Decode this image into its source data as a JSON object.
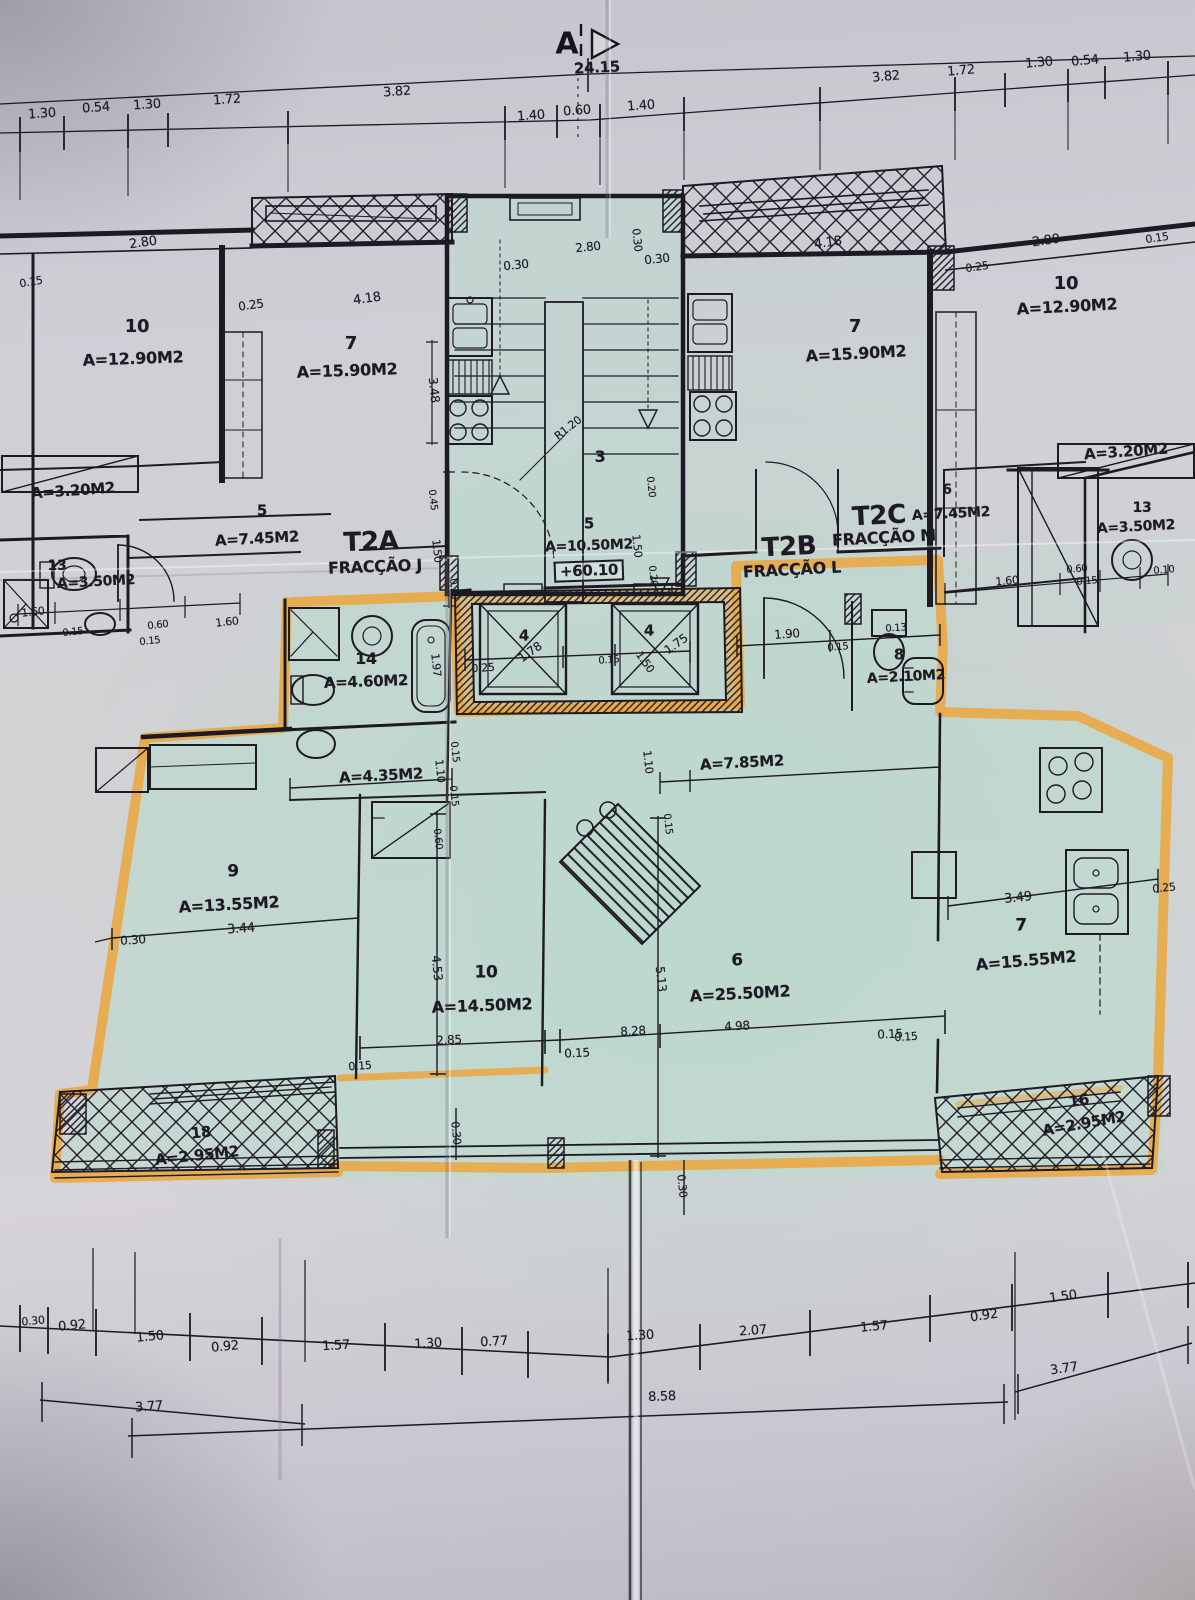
{
  "marker": {
    "letter": "A"
  },
  "colors": {
    "paper": "#cdc9d1",
    "blueprint_tint": "#bfdcd1",
    "ink": "#1b1822",
    "highlighter_orange": "#efa233"
  },
  "fractions": [
    {
      "code": "T2A",
      "name": "FRACÇÃO J"
    },
    {
      "code": "T2B",
      "name": "FRACÇÃO L"
    },
    {
      "code": "T2C",
      "name": "FRACÇÃO M"
    }
  ],
  "level_mark": "+60.10",
  "overall_width_dim": "24.15",
  "labels": [
    {
      "t": "24.15",
      "x": 597,
      "y": 68,
      "r": -3,
      "s": 15,
      "w": 1,
      "n": "overall-dim"
    },
    {
      "t": "1.30",
      "x": 42,
      "y": 114,
      "r": -4,
      "s": 13
    },
    {
      "t": "0.54",
      "x": 96,
      "y": 108,
      "r": -4,
      "s": 13
    },
    {
      "t": "1.30",
      "x": 147,
      "y": 105,
      "r": -4,
      "s": 13
    },
    {
      "t": "1.72",
      "x": 227,
      "y": 100,
      "r": -4,
      "s": 13
    },
    {
      "t": "3.82",
      "x": 397,
      "y": 92,
      "r": -4,
      "s": 13
    },
    {
      "t": "1.40",
      "x": 531,
      "y": 116,
      "r": -4,
      "s": 13
    },
    {
      "t": "0.60",
      "x": 577,
      "y": 111,
      "r": -4,
      "s": 13
    },
    {
      "t": "1.40",
      "x": 641,
      "y": 106,
      "r": -4,
      "s": 13
    },
    {
      "t": "3.82",
      "x": 886,
      "y": 77,
      "r": -5,
      "s": 13
    },
    {
      "t": "1.72",
      "x": 961,
      "y": 71,
      "r": -5,
      "s": 13
    },
    {
      "t": "1.30",
      "x": 1039,
      "y": 63,
      "r": -5,
      "s": 13
    },
    {
      "t": "0.54",
      "x": 1085,
      "y": 61,
      "r": -5,
      "s": 13
    },
    {
      "t": "1.30",
      "x": 1137,
      "y": 57,
      "r": -5,
      "s": 13
    },
    {
      "t": "0.15",
      "x": 31,
      "y": 282,
      "r": -10,
      "s": 11
    },
    {
      "t": "2.80",
      "x": 143,
      "y": 243,
      "r": -8,
      "s": 13
    },
    {
      "t": "10",
      "x": 137,
      "y": 327,
      "r": 0,
      "s": 18,
      "w": 1,
      "n": "room-number"
    },
    {
      "t": "A=12.90M2",
      "x": 133,
      "y": 359,
      "r": -2,
      "s": 16,
      "w": 1,
      "n": "room-area"
    },
    {
      "t": "0.25",
      "x": 251,
      "y": 305,
      "r": -8,
      "s": 12
    },
    {
      "t": "4.18",
      "x": 367,
      "y": 299,
      "r": -8,
      "s": 13
    },
    {
      "t": "7",
      "x": 351,
      "y": 344,
      "r": 0,
      "s": 18,
      "w": 1,
      "n": "room-number"
    },
    {
      "t": "A=15.90M2",
      "x": 347,
      "y": 371,
      "r": -2,
      "s": 16,
      "w": 1,
      "n": "room-area"
    },
    {
      "t": "3.48",
      "x": 434,
      "y": 390,
      "r": 84,
      "s": 12
    },
    {
      "t": "A=3.20M2",
      "x": 73,
      "y": 491,
      "r": -4,
      "s": 15,
      "w": 1,
      "n": "room-area"
    },
    {
      "t": "5",
      "x": 262,
      "y": 511,
      "r": 0,
      "s": 15,
      "w": 1,
      "n": "room-number"
    },
    {
      "t": "A=7.45M2",
      "x": 257,
      "y": 539,
      "r": -3,
      "s": 15,
      "w": 1,
      "n": "room-area"
    },
    {
      "t": "13",
      "x": 57,
      "y": 566,
      "r": 0,
      "s": 14,
      "w": 1,
      "n": "room-number"
    },
    {
      "t": "A=3.50M2",
      "x": 96,
      "y": 582,
      "r": -3,
      "s": 14,
      "w": 1,
      "n": "room-area"
    },
    {
      "t": "1.60",
      "x": 33,
      "y": 612,
      "r": -6,
      "s": 11
    },
    {
      "t": "0.15",
      "x": 73,
      "y": 633,
      "r": -6,
      "s": 10
    },
    {
      "t": "0.60",
      "x": 158,
      "y": 626,
      "r": -6,
      "s": 10
    },
    {
      "t": "0.15",
      "x": 150,
      "y": 642,
      "r": -6,
      "s": 10
    },
    {
      "t": "1.60",
      "x": 227,
      "y": 622,
      "r": -6,
      "s": 11
    },
    {
      "t": "0.30",
      "x": 516,
      "y": 265,
      "r": -6,
      "s": 12
    },
    {
      "t": "2.80",
      "x": 588,
      "y": 247,
      "r": -6,
      "s": 12
    },
    {
      "t": "0.30",
      "x": 637,
      "y": 240,
      "r": 84,
      "s": 11
    },
    {
      "t": "0.30",
      "x": 657,
      "y": 259,
      "r": -6,
      "s": 12
    },
    {
      "t": "R1.20",
      "x": 568,
      "y": 428,
      "r": -38,
      "s": 11
    },
    {
      "t": "3",
      "x": 600,
      "y": 457,
      "r": 0,
      "s": 16,
      "w": 1,
      "n": "room-number"
    },
    {
      "t": "0.20",
      "x": 650,
      "y": 487,
      "r": 84,
      "s": 10
    },
    {
      "t": "0.45",
      "x": 432,
      "y": 500,
      "r": 84,
      "s": 10
    },
    {
      "t": "1.50",
      "x": 437,
      "y": 551,
      "r": 84,
      "s": 11
    },
    {
      "t": "0.30",
      "x": 453,
      "y": 589,
      "r": 84,
      "s": 10
    },
    {
      "t": "1.50",
      "x": 637,
      "y": 546,
      "r": 84,
      "s": 11
    },
    {
      "t": "0.20",
      "x": 652,
      "y": 576,
      "r": 84,
      "s": 10
    },
    {
      "t": "4.18",
      "x": 828,
      "y": 243,
      "r": -8,
      "s": 13
    },
    {
      "t": "0.25",
      "x": 977,
      "y": 267,
      "r": -8,
      "s": 11
    },
    {
      "t": "2.80",
      "x": 1046,
      "y": 241,
      "r": -8,
      "s": 13
    },
    {
      "t": "0.15",
      "x": 1157,
      "y": 238,
      "r": -8,
      "s": 11
    },
    {
      "t": "10",
      "x": 1066,
      "y": 284,
      "r": 0,
      "s": 18,
      "w": 1,
      "n": "room-number"
    },
    {
      "t": "A=12.90M2",
      "x": 1067,
      "y": 307,
      "r": -3,
      "s": 16,
      "w": 1,
      "n": "room-area"
    },
    {
      "t": "7",
      "x": 855,
      "y": 327,
      "r": 0,
      "s": 18,
      "w": 1,
      "n": "room-number"
    },
    {
      "t": "A=15.90M2",
      "x": 856,
      "y": 354,
      "r": -3,
      "s": 16,
      "w": 1,
      "n": "room-area"
    },
    {
      "t": "A=3.20M2",
      "x": 1126,
      "y": 452,
      "r": -4,
      "s": 15,
      "w": 1,
      "n": "room-area"
    },
    {
      "t": "6",
      "x": 947,
      "y": 490,
      "r": 0,
      "s": 14,
      "w": 1,
      "n": "room-number"
    },
    {
      "t": "A=7.45M2",
      "x": 951,
      "y": 514,
      "r": -3,
      "s": 14,
      "w": 1,
      "n": "room-area"
    },
    {
      "t": "T2C",
      "x": 879,
      "y": 516,
      "r": -3,
      "s": 26,
      "w": 1,
      "n": "fraction-t2c-code"
    },
    {
      "t": "FRACÇÃO M",
      "x": 884,
      "y": 538,
      "r": -3,
      "s": 16,
      "w": 1,
      "n": "fraction-t2c-name"
    },
    {
      "t": "T2B",
      "x": 789,
      "y": 547,
      "r": -3,
      "s": 26,
      "w": 1,
      "n": "fraction-t2b-code"
    },
    {
      "t": "FRACÇÃO L",
      "x": 792,
      "y": 570,
      "r": -3,
      "s": 16,
      "w": 1,
      "n": "fraction-t2b-name"
    },
    {
      "t": "13",
      "x": 1142,
      "y": 508,
      "r": 0,
      "s": 14,
      "w": 1,
      "n": "room-number"
    },
    {
      "t": "A=3.50M2",
      "x": 1136,
      "y": 527,
      "r": -3,
      "s": 14,
      "w": 1,
      "n": "room-area"
    },
    {
      "t": "1.60",
      "x": 1007,
      "y": 581,
      "r": -5,
      "s": 11
    },
    {
      "t": "0.60",
      "x": 1077,
      "y": 570,
      "r": -5,
      "s": 10
    },
    {
      "t": "0.15",
      "x": 1087,
      "y": 582,
      "r": -5,
      "s": 10
    },
    {
      "t": "0.10",
      "x": 1164,
      "y": 571,
      "r": -5,
      "s": 10
    },
    {
      "t": "T2A",
      "x": 371,
      "y": 542,
      "r": -2,
      "s": 26,
      "w": 1,
      "n": "fraction-t2a-code"
    },
    {
      "t": "FRACÇÃO J",
      "x": 375,
      "y": 567,
      "r": -2,
      "s": 16,
      "w": 1,
      "n": "fraction-t2a-name"
    },
    {
      "t": "5",
      "x": 589,
      "y": 524,
      "r": 0,
      "s": 15,
      "w": 1,
      "n": "room-number"
    },
    {
      "t": "A=10.50M2",
      "x": 589,
      "y": 546,
      "r": -2,
      "s": 14,
      "w": 1,
      "n": "room-area"
    },
    {
      "t": "+60.10",
      "x": 589,
      "y": 571,
      "r": -2,
      "s": 15,
      "w": 1,
      "b": 1,
      "n": "level-mark"
    },
    {
      "t": "14",
      "x": 366,
      "y": 659,
      "r": 0,
      "s": 16,
      "w": 1,
      "n": "room-number"
    },
    {
      "t": "A=4.60M2",
      "x": 366,
      "y": 682,
      "r": -2,
      "s": 15,
      "w": 1,
      "n": "room-area"
    },
    {
      "t": "1.97",
      "x": 436,
      "y": 665,
      "r": 84,
      "s": 11
    },
    {
      "t": "0.25",
      "x": 483,
      "y": 668,
      "r": -4,
      "s": 11
    },
    {
      "t": "4",
      "x": 524,
      "y": 636,
      "r": 0,
      "s": 15,
      "w": 1,
      "n": "room-number"
    },
    {
      "t": "1.78",
      "x": 530,
      "y": 652,
      "r": -35,
      "s": 12
    },
    {
      "t": "0.15",
      "x": 609,
      "y": 661,
      "r": -4,
      "s": 10
    },
    {
      "t": "1.50",
      "x": 645,
      "y": 662,
      "r": 55,
      "s": 11
    },
    {
      "t": "4",
      "x": 649,
      "y": 631,
      "r": 0,
      "s": 15,
      "w": 1,
      "n": "room-number"
    },
    {
      "t": "1.75",
      "x": 676,
      "y": 644,
      "r": -35,
      "s": 12
    },
    {
      "t": "1.90",
      "x": 787,
      "y": 634,
      "r": -4,
      "s": 12
    },
    {
      "t": "0.15",
      "x": 838,
      "y": 648,
      "r": -4,
      "s": 10
    },
    {
      "t": "0.13",
      "x": 896,
      "y": 629,
      "r": -4,
      "s": 10
    },
    {
      "t": "8",
      "x": 899,
      "y": 655,
      "r": 0,
      "s": 15,
      "w": 1,
      "n": "room-number"
    },
    {
      "t": "A=2.10M2",
      "x": 906,
      "y": 677,
      "r": -3,
      "s": 14,
      "w": 1,
      "n": "room-area"
    },
    {
      "t": "A=4.35M2",
      "x": 381,
      "y": 776,
      "r": -3,
      "s": 15,
      "w": 1,
      "n": "room-area"
    },
    {
      "t": "1.10",
      "x": 440,
      "y": 771,
      "r": 84,
      "s": 11
    },
    {
      "t": "0.15",
      "x": 454,
      "y": 752,
      "r": 84,
      "s": 10
    },
    {
      "t": "0.15",
      "x": 453,
      "y": 796,
      "r": 84,
      "s": 10
    },
    {
      "t": "0.60",
      "x": 437,
      "y": 839,
      "r": 84,
      "s": 10
    },
    {
      "t": "1.10",
      "x": 648,
      "y": 762,
      "r": 84,
      "s": 11
    },
    {
      "t": "0.15",
      "x": 667,
      "y": 824,
      "r": 84,
      "s": 10
    },
    {
      "t": "A=7.85M2",
      "x": 742,
      "y": 763,
      "r": -3,
      "s": 15,
      "w": 1,
      "n": "room-area"
    },
    {
      "t": "9",
      "x": 233,
      "y": 872,
      "r": 0,
      "s": 17,
      "w": 1,
      "n": "room-number"
    },
    {
      "t": "A=13.55M2",
      "x": 229,
      "y": 905,
      "r": -3,
      "s": 16,
      "w": 1,
      "n": "room-area"
    },
    {
      "t": "3.44",
      "x": 241,
      "y": 929,
      "r": -4,
      "s": 13
    },
    {
      "t": "0.30",
      "x": 133,
      "y": 940,
      "r": -4,
      "s": 12
    },
    {
      "t": "4.53",
      "x": 437,
      "y": 968,
      "r": 84,
      "s": 12
    },
    {
      "t": "10",
      "x": 486,
      "y": 973,
      "r": 0,
      "s": 17,
      "w": 1,
      "n": "room-number"
    },
    {
      "t": "A=14.50M2",
      "x": 482,
      "y": 1006,
      "r": -2,
      "s": 16,
      "w": 1,
      "n": "room-area"
    },
    {
      "t": "2.85",
      "x": 449,
      "y": 1040,
      "r": -3,
      "s": 12
    },
    {
      "t": "0.15",
      "x": 577,
      "y": 1053,
      "r": -3,
      "s": 12
    },
    {
      "t": "5.13",
      "x": 661,
      "y": 979,
      "r": 84,
      "s": 12
    },
    {
      "t": "8.28",
      "x": 633,
      "y": 1031,
      "r": -3,
      "s": 12
    },
    {
      "t": "6",
      "x": 737,
      "y": 961,
      "r": 0,
      "s": 17,
      "w": 1,
      "n": "room-number"
    },
    {
      "t": "A=25.50M2",
      "x": 740,
      "y": 994,
      "r": -3,
      "s": 16,
      "w": 1,
      "n": "room-area"
    },
    {
      "t": "4.98",
      "x": 737,
      "y": 1026,
      "r": -3,
      "s": 12
    },
    {
      "t": "0.15",
      "x": 890,
      "y": 1034,
      "r": -3,
      "s": 12
    },
    {
      "t": "3.49",
      "x": 1018,
      "y": 898,
      "r": -6,
      "s": 13
    },
    {
      "t": "7",
      "x": 1021,
      "y": 926,
      "r": 0,
      "s": 17,
      "w": 1,
      "n": "room-number"
    },
    {
      "t": "A=15.55M2",
      "x": 1026,
      "y": 961,
      "r": -5,
      "s": 16,
      "w": 1,
      "n": "room-area"
    },
    {
      "t": "0.25",
      "x": 1164,
      "y": 888,
      "r": -6,
      "s": 11
    },
    {
      "t": "0.15",
      "x": 906,
      "y": 1037,
      "r": -4,
      "s": 11
    },
    {
      "t": "0.15",
      "x": 360,
      "y": 1066,
      "r": -4,
      "s": 11
    },
    {
      "t": "18",
      "x": 201,
      "y": 1133,
      "r": -6,
      "s": 15,
      "w": 1,
      "n": "room-number"
    },
    {
      "t": "A=2.95M2",
      "x": 197,
      "y": 1156,
      "r": -6,
      "s": 15,
      "w": 1,
      "n": "room-area"
    },
    {
      "t": "0.30",
      "x": 456,
      "y": 1133,
      "r": 84,
      "s": 11
    },
    {
      "t": "0.30",
      "x": 682,
      "y": 1186,
      "r": 84,
      "s": 11
    },
    {
      "t": "16",
      "x": 1079,
      "y": 1101,
      "r": -10,
      "s": 15,
      "w": 1,
      "n": "room-number"
    },
    {
      "t": "A=2.95M2",
      "x": 1084,
      "y": 1124,
      "r": -10,
      "s": 15,
      "w": 1,
      "n": "room-area"
    },
    {
      "t": "0.30",
      "x": 33,
      "y": 1321,
      "r": -5,
      "s": 11
    },
    {
      "t": "0.92",
      "x": 72,
      "y": 1326,
      "r": -5,
      "s": 13
    },
    {
      "t": "1.50",
      "x": 150,
      "y": 1337,
      "r": -5,
      "s": 13
    },
    {
      "t": "0.92",
      "x": 225,
      "y": 1347,
      "r": -5,
      "s": 13
    },
    {
      "t": "1.57",
      "x": 336,
      "y": 1346,
      "r": -3,
      "s": 13
    },
    {
      "t": "1.30",
      "x": 428,
      "y": 1344,
      "r": -3,
      "s": 13
    },
    {
      "t": "0.77",
      "x": 494,
      "y": 1342,
      "r": -3,
      "s": 13
    },
    {
      "t": "1.30",
      "x": 640,
      "y": 1336,
      "r": -3,
      "s": 13
    },
    {
      "t": "2.07",
      "x": 753,
      "y": 1331,
      "r": -4,
      "s": 13
    },
    {
      "t": "1.57",
      "x": 874,
      "y": 1327,
      "r": -5,
      "s": 13
    },
    {
      "t": "0.92",
      "x": 984,
      "y": 1316,
      "r": -8,
      "s": 13
    },
    {
      "t": "1.50",
      "x": 1063,
      "y": 1297,
      "r": -8,
      "s": 13
    },
    {
      "t": "3.77",
      "x": 149,
      "y": 1407,
      "r": -4,
      "s": 13
    },
    {
      "t": "8.58",
      "x": 662,
      "y": 1397,
      "r": -2,
      "s": 13
    },
    {
      "t": "3.77",
      "x": 1064,
      "y": 1369,
      "r": -8,
      "s": 13
    }
  ]
}
